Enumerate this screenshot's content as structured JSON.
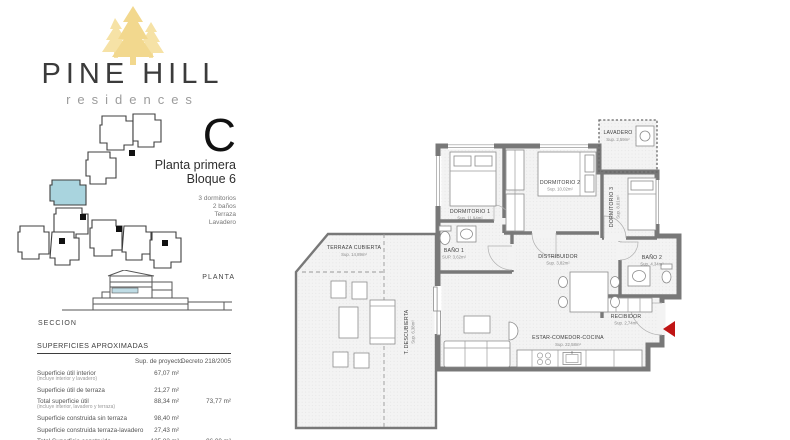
{
  "brand": {
    "name": "PINE HILL",
    "tagline": "residences"
  },
  "unit": {
    "letter": "C",
    "floor": "Planta primera",
    "block": "Bloque 6",
    "features": [
      "3 dormitorios",
      "2 baños",
      "Terraza",
      "Lavadero"
    ]
  },
  "diagrams": {
    "site_label": "PLANTA",
    "section_label": "SECCION"
  },
  "surfaces": {
    "title": "SUPERFICIES APROXIMADAS",
    "columns": [
      "Sup. de proyecto",
      "Decreto 218/2005"
    ],
    "rows": [
      {
        "label": "Superficie útil interior",
        "sub": "(incluye interior y lavadero)",
        "project": "67,07 m²",
        "decree": ""
      },
      {
        "label": "Superficie útil de terraza",
        "sub": "",
        "project": "21,27 m²",
        "decree": ""
      },
      {
        "label": "Total superficie útil",
        "sub": "(incluye interior, lavadero y terraza)",
        "project": "88,34 m²",
        "decree": "73,77 m²"
      },
      {
        "label": "Superficie construida sin terraza",
        "sub": "",
        "project": "98,40 m²",
        "decree": ""
      },
      {
        "label": "Superficie construida terraza-lavadero",
        "sub": "",
        "project": "27,43 m²",
        "decree": ""
      },
      {
        "label": "Total Superficie construida",
        "sub": "",
        "project": "125,83 m²",
        "decree": "96,00 m²"
      }
    ]
  },
  "floorplan": {
    "rooms": [
      {
        "name": "TERRAZA CUBIERTA",
        "area": "Sup. 14,89m²"
      },
      {
        "name": "T. DESCUBIERTA",
        "area": "Sup. 6,38m²"
      },
      {
        "name": "DORMITORIO 1",
        "area": "Sup. 11,94m²"
      },
      {
        "name": "DORMITORIO 2",
        "area": "Sup. 10,02m²"
      },
      {
        "name": "DORMITORIO 3",
        "area": "Sup. 8,01m²"
      },
      {
        "name": "LAVADERO",
        "area": "Sup. 2,59m²"
      },
      {
        "name": "BAÑO 1",
        "area": "SUP. 3,62m²"
      },
      {
        "name": "DISTRIBUIDOR",
        "area": "Sup. 3,82m²"
      },
      {
        "name": "BAÑO 2",
        "area": "Sup. 4,34m²"
      },
      {
        "name": "RECIBIDOR",
        "area": "Sup. 2,74m²"
      },
      {
        "name": "ESTAR-COMEDOR-COCINA",
        "area": "Sup. 22,58m²"
      }
    ]
  },
  "colors": {
    "accent_gold": "#f2d88e",
    "accent_gold_light": "#f6e2a6",
    "highlight_blue": "#a9d4de",
    "section_blue": "#bfdce5",
    "arrow_red": "#c01515"
  }
}
